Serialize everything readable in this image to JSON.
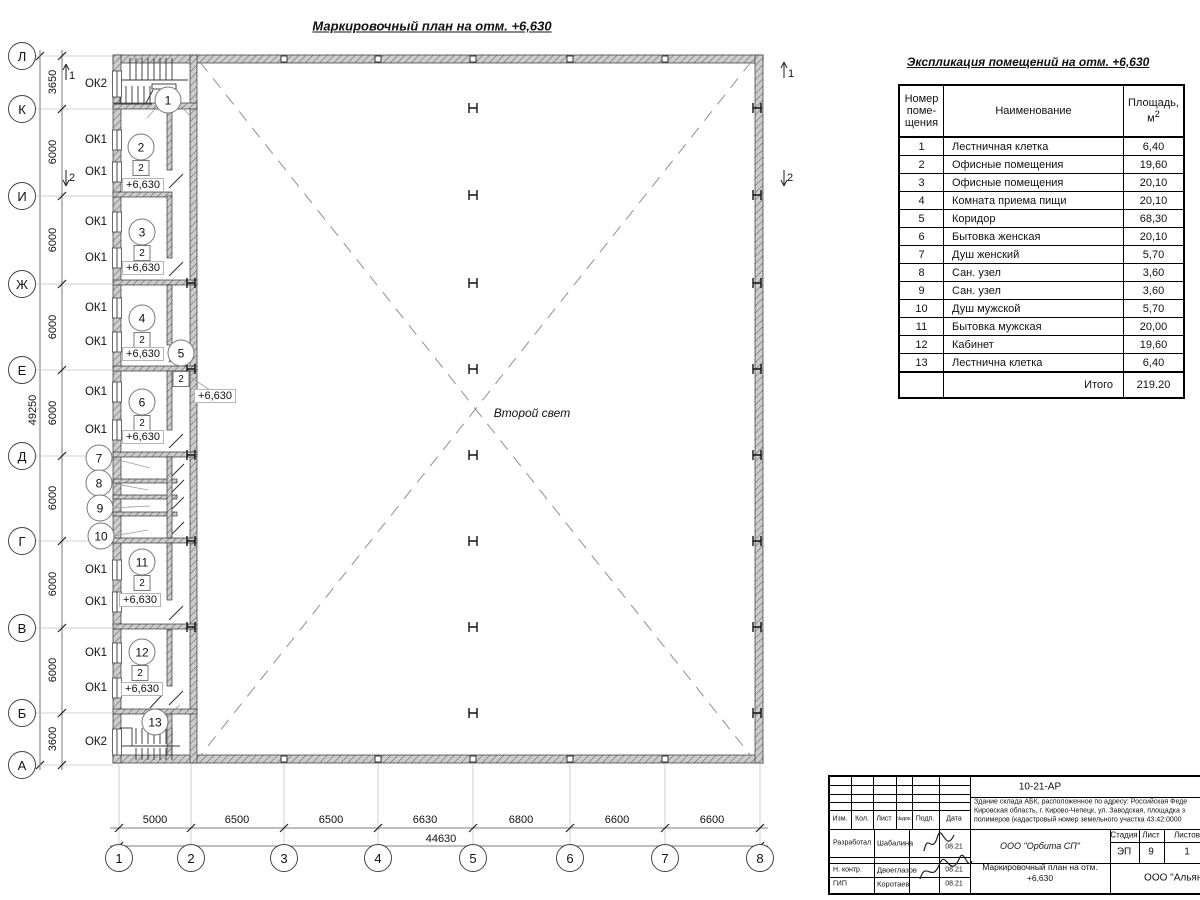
{
  "plan": {
    "title": "Маркировочный план на отм. +6,630",
    "second_light": "Второй свет",
    "left_axes": [
      {
        "label": "Л",
        "y": 56
      },
      {
        "label": "К",
        "y": 109
      },
      {
        "label": "И",
        "y": 196
      },
      {
        "label": "Ж",
        "y": 284
      },
      {
        "label": "Е",
        "y": 370
      },
      {
        "label": "Д",
        "y": 456
      },
      {
        "label": "Г",
        "y": 541
      },
      {
        "label": "В",
        "y": 628
      },
      {
        "label": "Б",
        "y": 713
      },
      {
        "label": "А",
        "y": 765
      }
    ],
    "left_dims": [
      {
        "value": "3650",
        "y": 82
      },
      {
        "value": "6000",
        "y": 152
      },
      {
        "value": "6000",
        "y": 240
      },
      {
        "value": "6000",
        "y": 327
      },
      {
        "value": "6000",
        "y": 413
      },
      {
        "value": "6000",
        "y": 498
      },
      {
        "value": "6000",
        "y": 584
      },
      {
        "value": "6000",
        "y": 670
      },
      {
        "value": "3600",
        "y": 739
      }
    ],
    "left_total": {
      "value": "49250",
      "x": 33,
      "y": 410
    },
    "bottom_axes": [
      {
        "label": "1",
        "x": 119
      },
      {
        "label": "2",
        "x": 191
      },
      {
        "label": "3",
        "x": 284
      },
      {
        "label": "4",
        "x": 378
      },
      {
        "label": "5",
        "x": 473
      },
      {
        "label": "6",
        "x": 570
      },
      {
        "label": "7",
        "x": 665
      },
      {
        "label": "8",
        "x": 760
      }
    ],
    "bottom_dims": [
      {
        "value": "5000",
        "x": 155
      },
      {
        "value": "6500",
        "x": 237
      },
      {
        "value": "6500",
        "x": 331
      },
      {
        "value": "6630",
        "x": 425
      },
      {
        "value": "6800",
        "x": 521
      },
      {
        "value": "6600",
        "x": 617
      },
      {
        "value": "6600",
        "x": 712
      }
    ],
    "bottom_total": {
      "value": "44630",
      "x": 441,
      "y": 839
    },
    "window_labels": [
      {
        "label": "ОК2",
        "x": 96,
        "y": 84
      },
      {
        "label": "ОК1",
        "x": 96,
        "y": 140
      },
      {
        "label": "ОК1",
        "x": 96,
        "y": 172
      },
      {
        "label": "ОК1",
        "x": 96,
        "y": 222
      },
      {
        "label": "ОК1",
        "x": 96,
        "y": 258
      },
      {
        "label": "ОК1",
        "x": 96,
        "y": 308
      },
      {
        "label": "ОК1",
        "x": 96,
        "y": 342
      },
      {
        "label": "ОК1",
        "x": 96,
        "y": 392
      },
      {
        "label": "ОК1",
        "x": 96,
        "y": 430
      },
      {
        "label": "ОК1",
        "x": 96,
        "y": 570
      },
      {
        "label": "ОК1",
        "x": 96,
        "y": 602
      },
      {
        "label": "ОК1",
        "x": 96,
        "y": 653
      },
      {
        "label": "ОК1",
        "x": 96,
        "y": 688
      },
      {
        "label": "ОК2",
        "x": 96,
        "y": 742
      }
    ],
    "window_symbols": [
      {
        "y": 84,
        "h": 26
      },
      {
        "y": 140,
        "h": 20
      },
      {
        "y": 172,
        "h": 20
      },
      {
        "y": 222,
        "h": 20
      },
      {
        "y": 258,
        "h": 20
      },
      {
        "y": 308,
        "h": 20
      },
      {
        "y": 342,
        "h": 20
      },
      {
        "y": 392,
        "h": 20
      },
      {
        "y": 430,
        "h": 20
      },
      {
        "y": 570,
        "h": 20
      },
      {
        "y": 602,
        "h": 20
      },
      {
        "y": 653,
        "h": 20
      },
      {
        "y": 688,
        "h": 20
      },
      {
        "y": 742,
        "h": 26
      }
    ],
    "room_marks": [
      {
        "label": "1",
        "x": 168,
        "y": 100
      },
      {
        "label": "2",
        "x": 141,
        "y": 147
      },
      {
        "label": "3",
        "x": 142,
        "y": 232
      },
      {
        "label": "4",
        "x": 142,
        "y": 318
      },
      {
        "label": "5",
        "x": 181,
        "y": 353
      },
      {
        "label": "6",
        "x": 142,
        "y": 402
      },
      {
        "label": "7",
        "x": 99,
        "y": 458
      },
      {
        "label": "8",
        "x": 99,
        "y": 483
      },
      {
        "label": "9",
        "x": 100,
        "y": 508
      },
      {
        "label": "10",
        "x": 101,
        "y": 536
      },
      {
        "label": "11",
        "x": 142,
        "y": 562
      },
      {
        "label": "12",
        "x": 142,
        "y": 652
      },
      {
        "label": "13",
        "x": 155,
        "y": 722
      }
    ],
    "door_marks": [
      {
        "label": "2",
        "x": 141,
        "y": 168
      },
      {
        "label": "2",
        "x": 142,
        "y": 253
      },
      {
        "label": "2",
        "x": 142,
        "y": 340
      },
      {
        "label": "2",
        "x": 181,
        "y": 379
      },
      {
        "label": "2",
        "x": 142,
        "y": 423
      },
      {
        "label": "2",
        "x": 142,
        "y": 583
      },
      {
        "label": "2",
        "x": 140,
        "y": 673
      }
    ],
    "elevation_marks": [
      {
        "label": "+6,630",
        "x": 143,
        "y": 185
      },
      {
        "label": "+6,630",
        "x": 143,
        "y": 268
      },
      {
        "label": "+6,630",
        "x": 143,
        "y": 354
      },
      {
        "label": "+6,630",
        "x": 215,
        "y": 396
      },
      {
        "label": "+6,630",
        "x": 143,
        "y": 437
      },
      {
        "label": "+6,630",
        "x": 140,
        "y": 600
      },
      {
        "label": "+6,630",
        "x": 142,
        "y": 689
      }
    ],
    "section_labels": [
      {
        "label": "1",
        "x": 72,
        "y": 76
      },
      {
        "label": "2",
        "x": 72,
        "y": 178
      },
      {
        "label": "1",
        "x": 791,
        "y": 74
      },
      {
        "label": "2",
        "x": 790,
        "y": 178
      }
    ],
    "h_marks": [
      {
        "x": 473,
        "ys": [
          108,
          195,
          283,
          369,
          455,
          541,
          627,
          713
        ]
      },
      {
        "x": 757,
        "ys": [
          108,
          195,
          283,
          369,
          455,
          541,
          627,
          713
        ]
      },
      {
        "x": 191,
        "ys": [
          283,
          369,
          455,
          541,
          627
        ]
      }
    ],
    "wall_squares": {
      "xs": [
        284,
        378,
        473,
        570,
        665
      ],
      "ys": [
        59,
        759
      ]
    }
  },
  "explication": {
    "title": "Экспликация помещений на отм. +6,630",
    "headers": {
      "num_lines": [
        "Номер",
        "поме-",
        "щения"
      ],
      "name": "Наименование",
      "area_line1": "Площадь,",
      "area_unit": "м",
      "area_sup": "2"
    },
    "rows": [
      [
        "1",
        "Лестничная клетка",
        "6,40"
      ],
      [
        "2",
        "Офисные помещения",
        "19,60"
      ],
      [
        "3",
        "Офисные помещения",
        "20,10"
      ],
      [
        "4",
        "Комната приема пищи",
        "20,10"
      ],
      [
        "5",
        "Коридор",
        "68,30"
      ],
      [
        "6",
        "Бытовка женская",
        "20,10"
      ],
      [
        "7",
        "Душ женский",
        "5,70"
      ],
      [
        "8",
        "Сан. узел",
        "3,60"
      ],
      [
        "9",
        "Сан. узел",
        "3,60"
      ],
      [
        "10",
        "Душ мужской",
        "5,70"
      ],
      [
        "11",
        "Бытовка мужская",
        "20,00"
      ],
      [
        "12",
        "Кабинет",
        "19,60"
      ],
      [
        "13",
        "Лестнична клетка",
        "6,40"
      ]
    ],
    "total_label": "Итого",
    "total_value": "219.20"
  },
  "title_block": {
    "doc_number": "10-21-АР",
    "address_lines": [
      "Здание склада АБК, расположенное по адресу: Российская Феде",
      "Кировская область, г. Кирово-Чепецк, ул. Заводская, площадка з",
      "полимеров (кадастровый номер земельного участка 43:42:0000"
    ],
    "rev_headers": [
      "Изм.",
      "Кол.",
      "Лист",
      "№док.",
      "Подп.",
      "Дата"
    ],
    "roles": [
      {
        "role": "Разработал",
        "name": "Шабалина",
        "date": "08.21"
      },
      {
        "role": "Н. контр.",
        "name": "Двоеглазов",
        "date": "08.21"
      },
      {
        "role": "ГИП",
        "name": "Коротаев",
        "date": "08.21"
      }
    ],
    "company": "ООО \"Орбита СП\"",
    "sheet_title_lines": [
      "Маркировочный план на отм.",
      "+6,630"
    ],
    "stage_headers": [
      "Стадия",
      "Лист",
      "Листов"
    ],
    "stage_values": [
      "ЭП",
      "9",
      "1"
    ],
    "company2": "ООО \"Альяно"
  }
}
